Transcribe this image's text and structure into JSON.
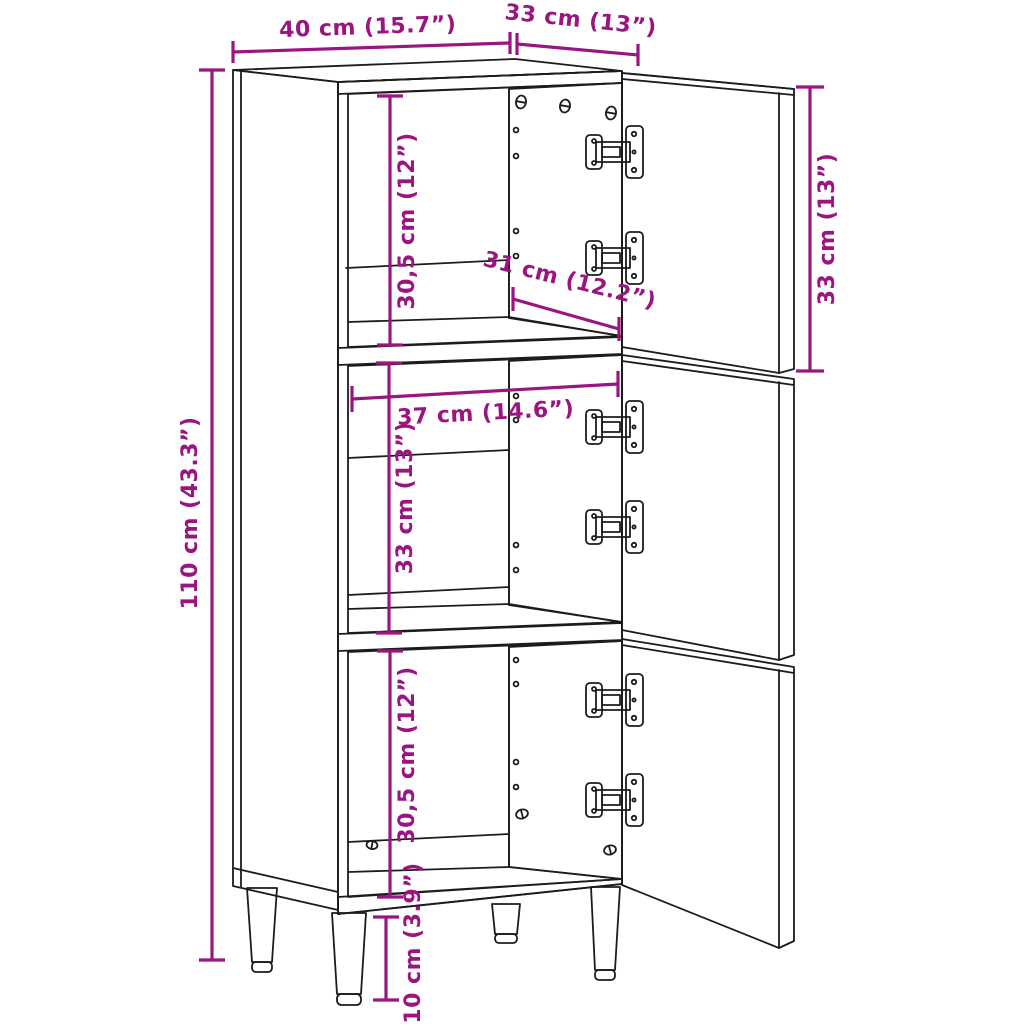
{
  "colors": {
    "dimension_annotation": "#9b1580",
    "line_art": "#1c1c1c",
    "background": "#ffffff"
  },
  "structure": {
    "compartments": 3,
    "doors": 3,
    "hinges": 6,
    "legs": 4,
    "shelves": 2
  },
  "dimensions": {
    "top_width": {
      "label": "40 cm (15.7”)",
      "value_cm": "40",
      "value_in": "15.7"
    },
    "top_depth": {
      "label": "33 cm (13”)",
      "value_cm": "33",
      "value_in": "13"
    },
    "door_height": {
      "label": "33 cm (13”)",
      "value_cm": "33",
      "value_in": "13"
    },
    "top_compartment": {
      "label": "30,5 cm (12”)",
      "value_cm": "30,5",
      "value_in": "12"
    },
    "shelf_depth": {
      "label": "31 cm (12.2”)",
      "value_cm": "31",
      "value_in": "12.2"
    },
    "inner_width": {
      "label": "37 cm (14.6”)",
      "value_cm": "37",
      "value_in": "14.6"
    },
    "mid_compartment": {
      "label": "33 cm (13”)",
      "value_cm": "33",
      "value_in": "13"
    },
    "total_height": {
      "label": "110 cm (43.3”)",
      "value_cm": "110",
      "value_in": "43.3"
    },
    "bottom_compartment": {
      "label": "30,5 cm (12”)",
      "value_cm": "30,5",
      "value_in": "12"
    },
    "leg_height": {
      "label": "10 cm (3.9”)",
      "value_cm": "10",
      "value_in": "3.9"
    }
  }
}
